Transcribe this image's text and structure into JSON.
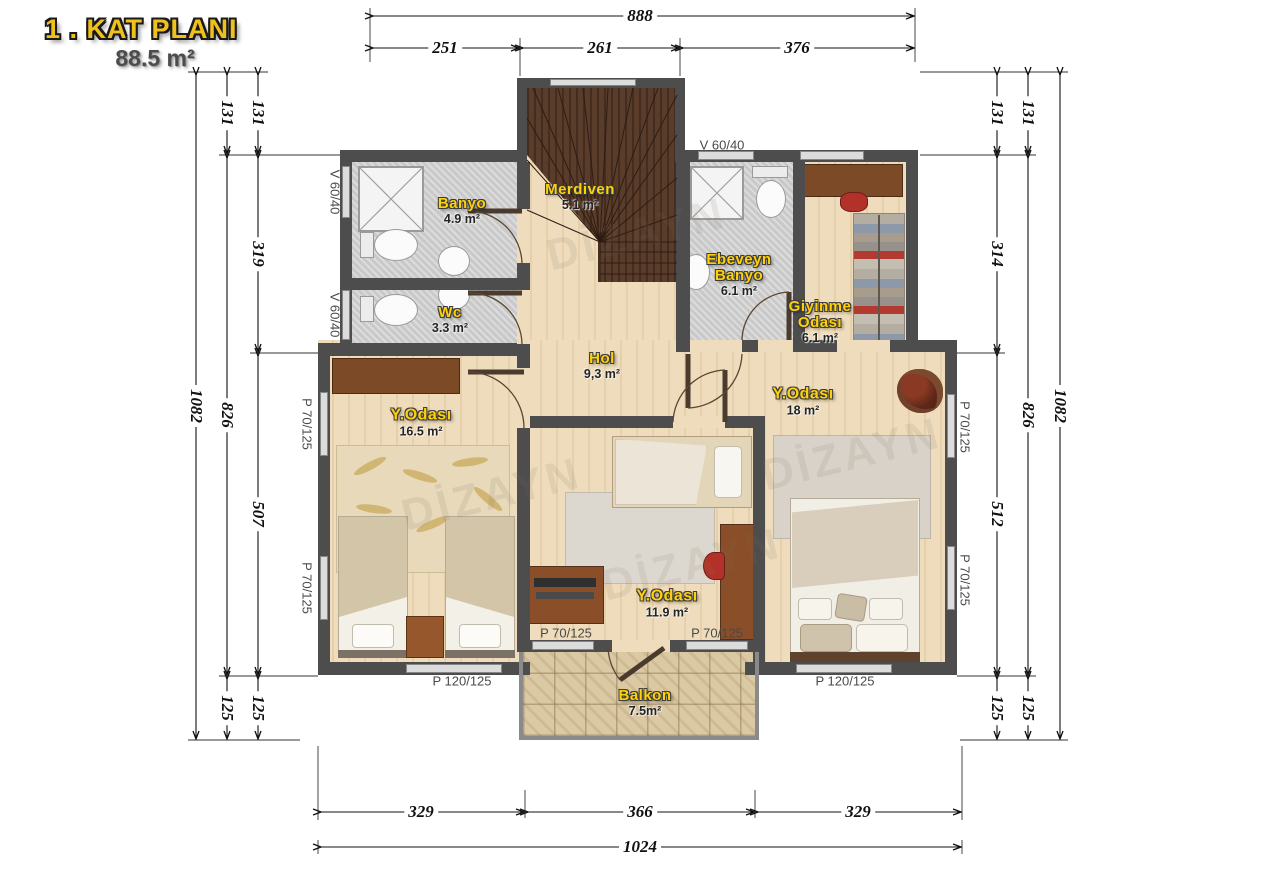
{
  "title": {
    "line1": "1 . KAT PLANI",
    "line2": "88.5 m²"
  },
  "watermark": "DİZAYN",
  "rooms": {
    "banyo": {
      "name": "Banyo",
      "area": "4.9 m²"
    },
    "merdiven": {
      "name": "Merdiven",
      "area": "5.1 m²"
    },
    "wc": {
      "name": "Wc",
      "area": "3.3 m²"
    },
    "ebeveyn_banyo": {
      "line1": "Ebeveyn",
      "line2": "Banyo",
      "area": "6.1 m²"
    },
    "giyinme": {
      "line1": "Giyinme",
      "line2": "Odası",
      "area": "6.1 m²"
    },
    "hol": {
      "name": "Hol",
      "area": "9,3 m²"
    },
    "yatak_sol": {
      "name": "Y.Odası",
      "area": "16.5 m²"
    },
    "yatak_sag": {
      "name": "Y.Odası",
      "area": "18 m²"
    },
    "yatak_orta": {
      "name": "Y.Odası",
      "area": "11.9 m²"
    },
    "balkon": {
      "name": "Balkon",
      "area": "7.5m²"
    }
  },
  "windows": {
    "v6040": "V 60/40",
    "p70125": "P 70/125",
    "p120125": "P 120/125"
  },
  "dimensions": {
    "top": {
      "total": "888",
      "segments": [
        "251",
        "261",
        "376"
      ]
    },
    "bottom": {
      "total": "1024",
      "segments": [
        "329",
        "366",
        "329"
      ]
    },
    "left": {
      "total": "1082",
      "mid": [
        "131",
        "826",
        "125"
      ],
      "inner": [
        "131",
        "319",
        "507",
        "125"
      ]
    },
    "right": {
      "total": "1082",
      "mid": [
        "131",
        "826",
        "125"
      ],
      "inner": [
        "131",
        "314",
        "512",
        "125"
      ]
    }
  },
  "colors": {
    "label_yellow": "#ffd10a",
    "wall_gray": "#4d4d4d",
    "stair_brown": "#5a3c2a",
    "accent_red": "#b23229"
  }
}
